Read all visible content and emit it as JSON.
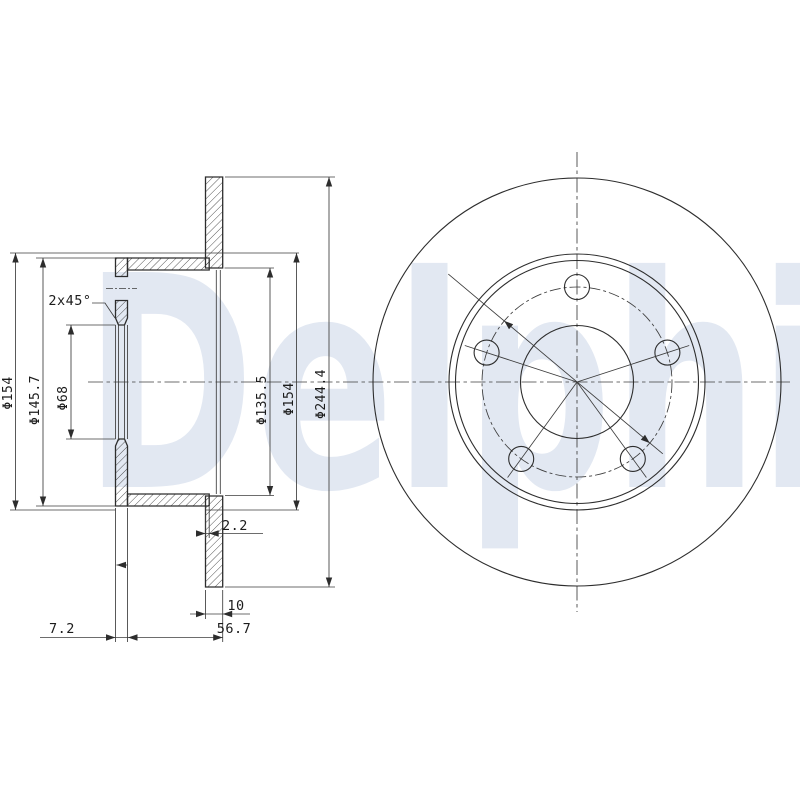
{
  "drawing": {
    "watermark_text": "Delphi",
    "section": {
      "dim_flange_od_left": "Φ154",
      "dim_hat_od": "Φ145.7",
      "dim_center_bore": "Φ68",
      "chamfer_note": "2x45°",
      "dim_friction_ring_id": "Φ135.5",
      "dim_flange_od_right": "Φ154",
      "dim_outer_diameter": "Φ244.4",
      "dim_face_offset": "2.2",
      "dim_disc_thickness": "10",
      "dim_hat_depth": "7.2",
      "dim_overall_width": "56.7"
    },
    "front": {
      "bolt_hole_count": 5
    },
    "colors": {
      "line": "#2d2d2d",
      "watermark": "#e2e8f2",
      "background": "#ffffff"
    }
  }
}
